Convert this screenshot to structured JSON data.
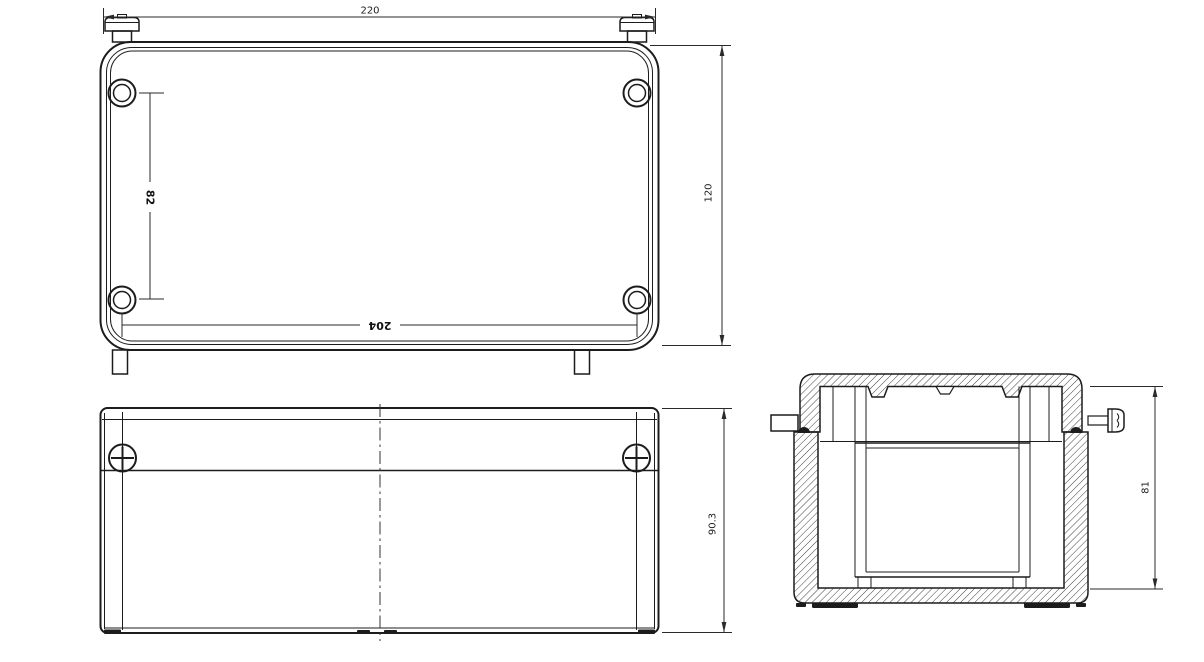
{
  "drawing": {
    "type": "engineering-3-view-enclosure-drawing",
    "background_color": "#ffffff",
    "line_color": "#1c1c1c",
    "dimension_color": "#2a2a2a",
    "views": {
      "top_view": {
        "dimensions": {
          "overall_width": "220",
          "overall_depth": "120",
          "hole_pitch_vertical": "82",
          "hole_pitch_horizontal": "204"
        }
      },
      "front_view": {
        "dimensions": {
          "overall_height": "90.3"
        }
      },
      "section_view": {
        "dimensions": {
          "inner_height": "81"
        }
      }
    }
  }
}
